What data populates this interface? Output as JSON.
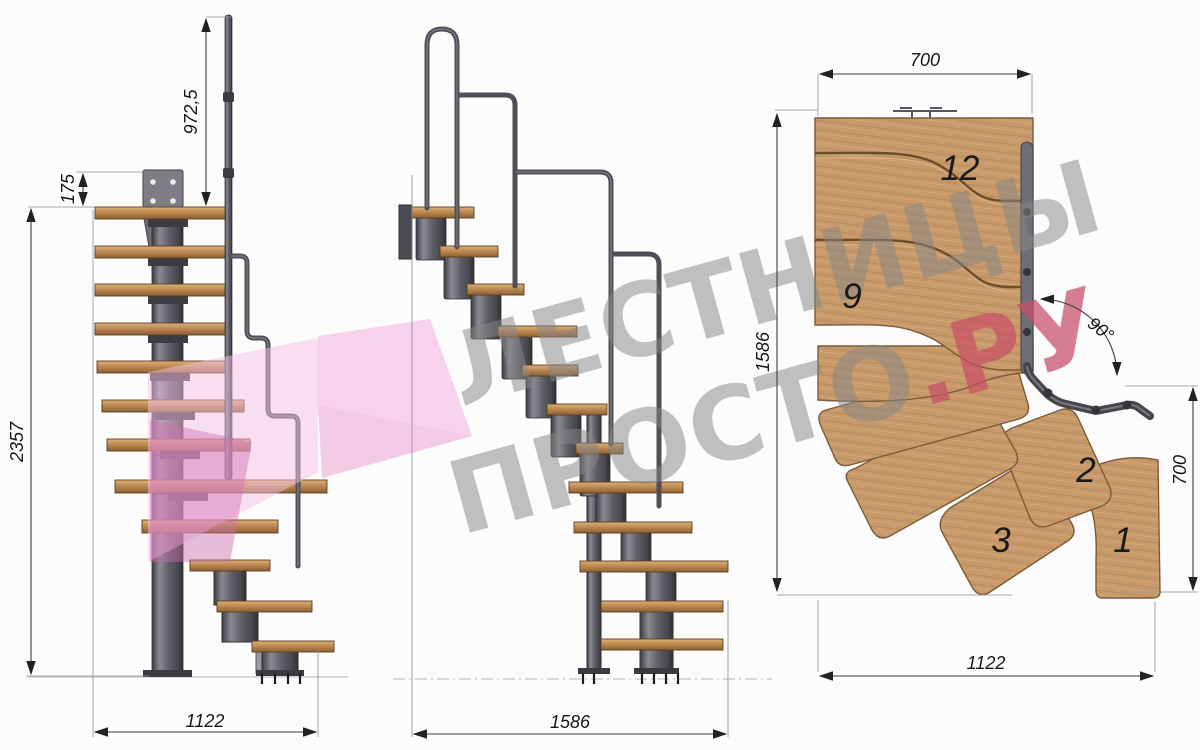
{
  "watermark": {
    "line1": "ЛЕСТНИЦЫ",
    "line2_gray": "ПРОСТО",
    "line2_red": ".РУ",
    "gray_color": "#868686",
    "red_color": "#c84d66",
    "pink_color": "#f3b4e1"
  },
  "dims": {
    "front": {
      "rail_height": "972,5",
      "plate_offset": "175",
      "total_height": "2357",
      "total_width": "1122"
    },
    "side": {
      "total_length": "1586"
    },
    "plan": {
      "landing_width": "700",
      "total_length": "1586",
      "angle": "90°",
      "lower_width": "700",
      "total_width": "1122"
    }
  },
  "plan_steps": {
    "s12": "12",
    "s9": "9",
    "s2": "2",
    "s3": "3",
    "s1": "1"
  },
  "colors": {
    "wood_plan": "#c89a6b",
    "wood_front": "#c08c55",
    "metal": "#55555c",
    "dimension_lines": "#3c3c3c"
  }
}
